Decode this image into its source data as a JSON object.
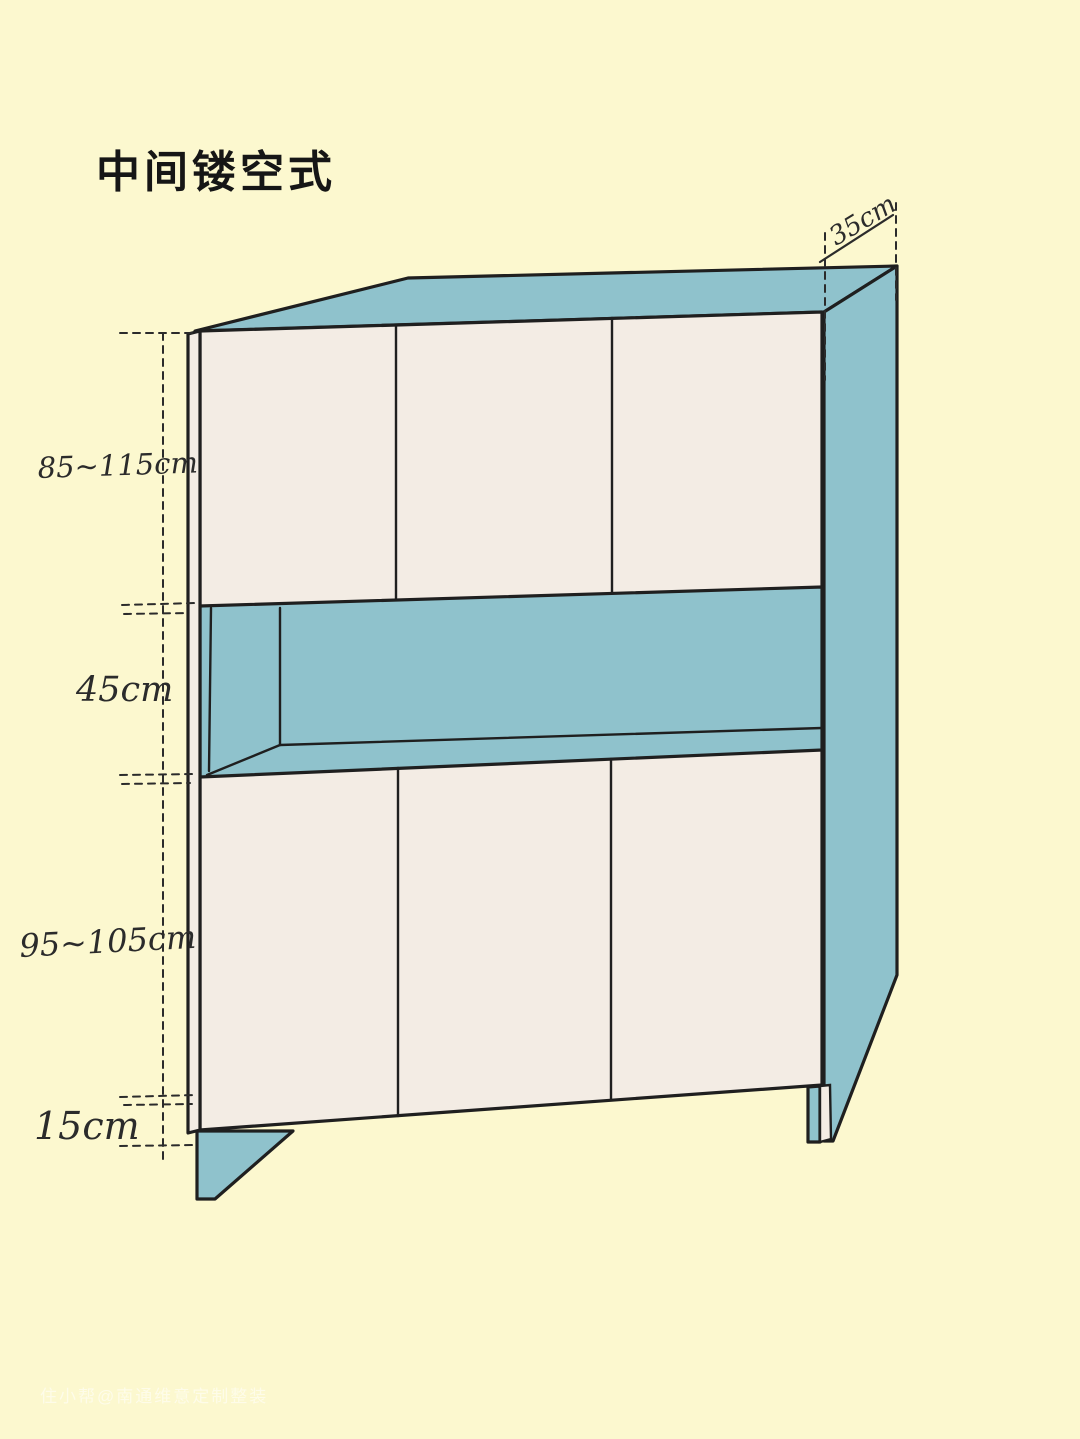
{
  "title": "中间镂空式",
  "watermark": "住小帮@南通维意定制整装",
  "labels": {
    "top_height": "85~115cm",
    "middle_height": "45cm",
    "bottom_height": "95~105cm",
    "base_height": "15cm",
    "depth": "35cm"
  },
  "colors": {
    "background": "#fcf8cf",
    "cabinet_panel": "#8fc2cc",
    "cabinet_door": "#f3ece4",
    "outline": "#1f1f1f",
    "dimension_text": "#2b2b2b",
    "title_text": "#161616",
    "watermark_text": "rgba(255,255,255,0.55)"
  },
  "figure": {
    "description": "hand-drawn cabinet with open middle shelf (hollow-out centre style)"
  }
}
